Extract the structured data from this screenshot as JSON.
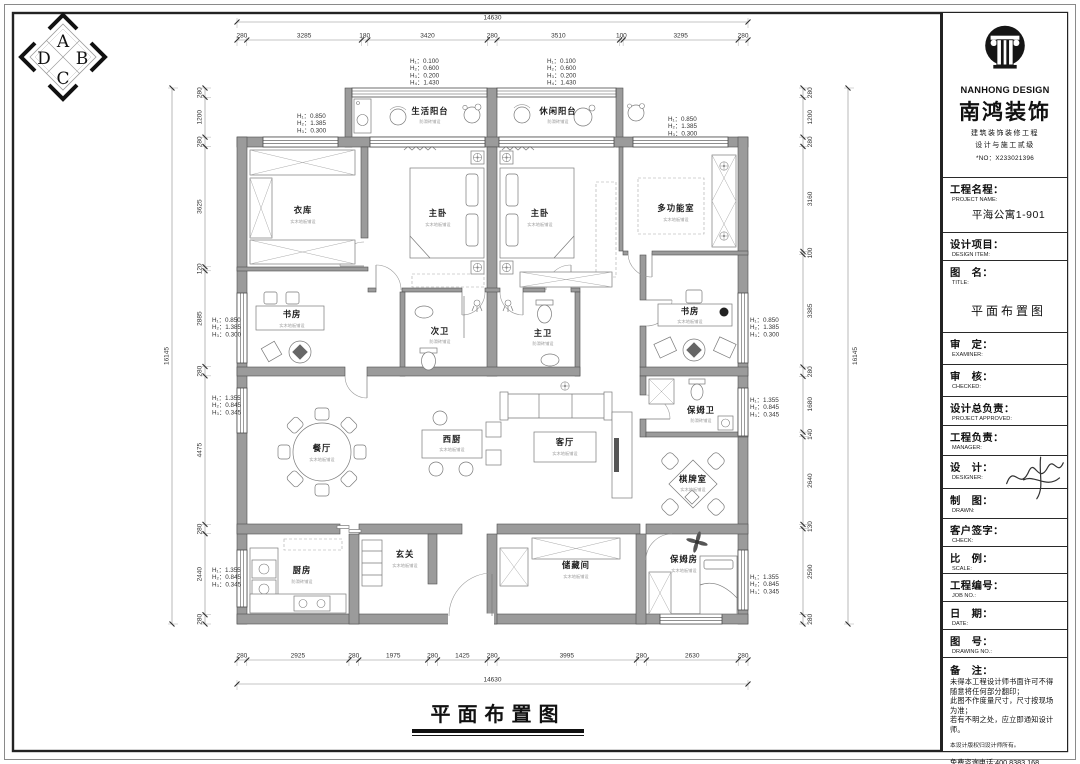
{
  "sheet": {
    "compass": {
      "a": "A",
      "b": "B",
      "c": "C",
      "d": "D"
    }
  },
  "title_block": {
    "brand": {
      "en": "NANHONG DESIGN",
      "cn": "南鸿装饰",
      "line1": "建筑装饰装修工程",
      "line2": "设计与施工贰级",
      "no": "*NO：X233021396"
    },
    "fields": [
      {
        "label_cn": "工程名程：",
        "label_en": "PROJECT NAME:",
        "value": "平海公寓1-901"
      },
      {
        "label_cn": "设计项目：",
        "label_en": "DESIGN ITEM:",
        "value": ""
      },
      {
        "label_cn": "图　名：",
        "label_en": "TITLE:",
        "value": "平面布置图"
      },
      {
        "label_cn": "审　定：",
        "label_en": "EXAMINER:",
        "value": ""
      },
      {
        "label_cn": "审　核：",
        "label_en": "CHECKED:",
        "value": ""
      },
      {
        "label_cn": "设计总负责：",
        "label_en": "PROJECT APPROVED:",
        "value": ""
      },
      {
        "label_cn": "工程负责：",
        "label_en": "MANAGER:",
        "value": ""
      },
      {
        "label_cn": "设　计：",
        "label_en": "DESIGNER:",
        "value": ""
      },
      {
        "label_cn": "制　图：",
        "label_en": "DRAWN:",
        "value": ""
      },
      {
        "label_cn": "客户签字：",
        "label_en": "CHECK:",
        "value": ""
      },
      {
        "label_cn": "比　例：",
        "label_en": "SCALE:",
        "value": ""
      },
      {
        "label_cn": "工程编号：",
        "label_en": "JOB  NO.:",
        "value": ""
      },
      {
        "label_cn": "日　期：",
        "label_en": "DATE:",
        "value": ""
      },
      {
        "label_cn": "图　号：",
        "label_en": "DRAWING NO.:",
        "value": ""
      }
    ],
    "notes": {
      "label_cn": "备　注：",
      "lines": [
        "未得本工程设计师书面许可不得",
        "随意将任何部分翻印；",
        "此图不作度量尺寸，尺寸按现场",
        "为准；",
        "若有不明之处，应立即通知设计",
        "师。"
      ],
      "copyright": "本设计版权归设计师所有。",
      "hotline": "免费咨询电话:400 8383 168"
    }
  },
  "plan": {
    "rooms": [
      {
        "name": "生活阳台",
        "sub": "防滑砖铺设"
      },
      {
        "name": "休闲阳台",
        "sub": "防滑砖铺设"
      },
      {
        "name": "衣库",
        "sub": "实木地板铺设"
      },
      {
        "name": "主卧",
        "sub": "实木地板铺设"
      },
      {
        "name": "主卧",
        "sub": "实木地板铺设"
      },
      {
        "name": "多功能室",
        "sub": "实木地板铺设"
      },
      {
        "name": "书房",
        "sub": "实木地板铺设"
      },
      {
        "name": "次卫",
        "sub": "防滑砖铺设"
      },
      {
        "name": "主卫",
        "sub": "防滑砖铺设"
      },
      {
        "name": "书房",
        "sub": "实木地板铺设"
      },
      {
        "name": "保姆卫",
        "sub": "防滑砖铺设"
      },
      {
        "name": "餐厅",
        "sub": "实木地板铺设"
      },
      {
        "name": "西厨",
        "sub": "实木地板铺设"
      },
      {
        "name": "客厅",
        "sub": "实木地板铺设"
      },
      {
        "name": "棋牌室",
        "sub": "实木地板铺设"
      },
      {
        "name": "厨房",
        "sub": "防滑砖铺设"
      },
      {
        "name": "玄关",
        "sub": "实木地板铺设"
      },
      {
        "name": "储藏间",
        "sub": "实木地板铺设"
      },
      {
        "name": "保姆房",
        "sub": "实木地板铺设"
      }
    ],
    "dims": {
      "top": {
        "total": "14630",
        "segments": [
          "280",
          "3285",
          "180",
          "3420",
          "280",
          "3510",
          "100",
          "3295",
          "280"
        ]
      },
      "bottom": {
        "total": "14630",
        "segments": [
          "280",
          "2925",
          "280",
          "1975",
          "280",
          "1425",
          "280",
          "3995",
          "280",
          "2630",
          "280"
        ]
      },
      "left": {
        "total": "16145",
        "segments": [
          "280",
          "1200",
          "280",
          "3625",
          "120",
          "2885",
          "280",
          "4475",
          "280",
          "2440",
          "280"
        ]
      },
      "right": {
        "total": "16145",
        "segments": [
          "280",
          "1200",
          "280",
          "3160",
          "100",
          "3385",
          "280",
          "1680",
          "140",
          "2640",
          "130",
          "2590",
          "280"
        ]
      }
    },
    "elevations": [
      {
        "lines": [
          "H₁：0.100",
          "H₂：0.600",
          "H₃：0.200",
          "H₄：1.430"
        ]
      },
      {
        "lines": [
          "H₁：0.100",
          "H₂：0.600",
          "H₃：0.200",
          "H₄：1.430"
        ]
      },
      {
        "lines": [
          "H₁：0.850",
          "H₂：1.385",
          "H₃：0.300"
        ]
      },
      {
        "lines": [
          "H₁：0.850",
          "H₂：1.385",
          "H₃：0.300"
        ]
      },
      {
        "lines": [
          "H₁：0.850",
          "H₂：1.385",
          "H₃：0.300"
        ]
      },
      {
        "lines": [
          "H₁：1.355",
          "H₂：0.845",
          "H₃：0.345"
        ]
      },
      {
        "lines": [
          "H₁：0.850",
          "H₂：1.385",
          "H₃：0.300"
        ]
      },
      {
        "lines": [
          "H₁：1.355",
          "H₂：0.845",
          "H₃：0.345"
        ]
      },
      {
        "lines": [
          "H₁：1.355",
          "H₂：0.845",
          "H₃：0.345"
        ]
      },
      {
        "lines": [
          "H₁：1.355",
          "H₂：0.845",
          "H₃：0.345"
        ]
      }
    ]
  },
  "footer": {
    "title": "平面布置图"
  }
}
